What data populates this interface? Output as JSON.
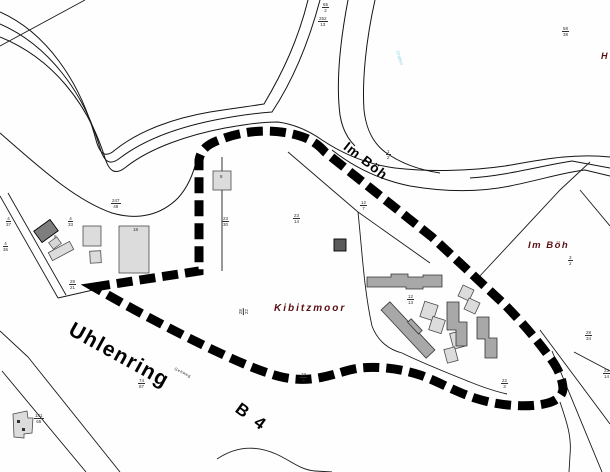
{
  "labels": {
    "street_uhlenring": "Uhlenring",
    "street_b4": "B 4",
    "street_im_boeh": "Im Böh",
    "area_kibitzmoor": "Kibitzmoor",
    "area_im_boeh": "Im Böh",
    "footpath": "Gehweg",
    "stream": "Graben",
    "edge_cut_label": "H"
  },
  "parcel_numbers": [
    {
      "text": "65/2",
      "x": 322,
      "y": 2,
      "rot": 0
    },
    {
      "text": "252/13",
      "x": 318,
      "y": 16,
      "rot": 0
    },
    {
      "text": "58/38",
      "x": 562,
      "y": 26,
      "rot": 0
    },
    {
      "text": "1/2",
      "x": 386,
      "y": 149,
      "rot": 0
    },
    {
      "text": "12/7",
      "x": 360,
      "y": 200,
      "rot": 0
    },
    {
      "text": "247/48",
      "x": 111,
      "y": 198,
      "rot": 0
    },
    {
      "text": "4/37",
      "x": 6,
      "y": 216,
      "rot": 0
    },
    {
      "text": "4/36",
      "x": 3,
      "y": 241,
      "rot": 0
    },
    {
      "text": "4/33",
      "x": 68,
      "y": 216,
      "rot": 0
    },
    {
      "text": "23/30",
      "x": 222,
      "y": 216,
      "rot": 0
    },
    {
      "text": "23/14",
      "x": 293,
      "y": 213,
      "rot": 0
    },
    {
      "text": "28/21",
      "x": 69,
      "y": 279,
      "rot": 0
    },
    {
      "text": "28/22",
      "x": 240,
      "y": 306,
      "rot": -90
    },
    {
      "text": "74/87",
      "x": 138,
      "y": 378,
      "rot": 0
    },
    {
      "text": "19/8",
      "x": 300,
      "y": 372,
      "rot": 0
    },
    {
      "text": "12/13",
      "x": 407,
      "y": 294,
      "rot": 0
    },
    {
      "text": "22/3",
      "x": 501,
      "y": 378,
      "rot": 0
    },
    {
      "text": "3/2",
      "x": 568,
      "y": 255,
      "rot": 0
    },
    {
      "text": "28/34",
      "x": 585,
      "y": 330,
      "rot": 0
    },
    {
      "text": "23/14",
      "x": 603,
      "y": 368,
      "rot": 0
    },
    {
      "text": "141/65",
      "x": 34,
      "y": 413,
      "rot": 0
    },
    {
      "text": "18",
      "x": 133,
      "y": 227,
      "rot": 0
    },
    {
      "text": "8",
      "x": 54,
      "y": 234,
      "rot": 0
    },
    {
      "text": "8",
      "x": 220,
      "y": 174,
      "rot": 0
    }
  ],
  "colors": {
    "boundary": "#000000",
    "flurname_text": "#5a1014",
    "stream_text": "#8ed3e6",
    "building_light": "#dcdcdc",
    "building_mid": "#a8a8a8",
    "building_dark": "#7e7e7e"
  }
}
